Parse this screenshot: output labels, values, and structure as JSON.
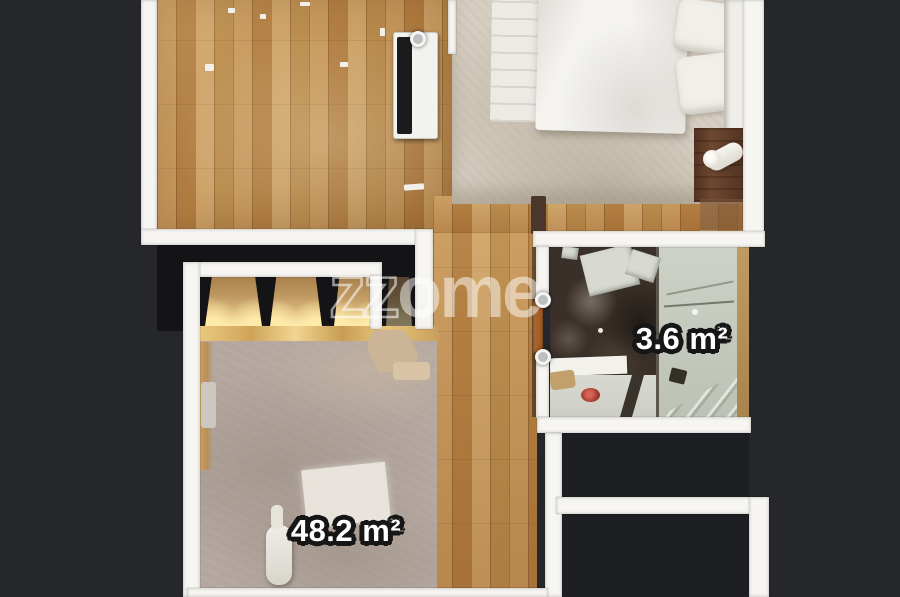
{
  "floorplan": {
    "labels": {
      "bathroom": {
        "text": "3.6 m²",
        "area_value": "3.6",
        "unit": "m²"
      },
      "living": {
        "text": "48.2 m²",
        "area_value": "48.2",
        "unit": "m²"
      }
    },
    "watermark": {
      "text": "zzome",
      "outline_part": "zz",
      "fill_part": "ome"
    },
    "camera_markers": [
      {
        "id": "marker-radiator",
        "x": 418,
        "y": 39
      },
      {
        "id": "marker-bath-door-top",
        "x": 543,
        "y": 300
      },
      {
        "id": "marker-bath-door-bottom",
        "x": 543,
        "y": 357
      }
    ],
    "palette": {
      "background": "#25272a",
      "wall": "#f6f5f1",
      "wood_floor": "#bd8e52",
      "bedroom_carpet": "#d6cec1",
      "living_carpet": "#b3a79f",
      "bathroom_floor": "#3a3029",
      "shower": "#c6cbc0",
      "closet_glow": "#f4dda4",
      "door": "#a8652f",
      "label_text": "#ffffff",
      "label_outline": "#161616"
    }
  }
}
